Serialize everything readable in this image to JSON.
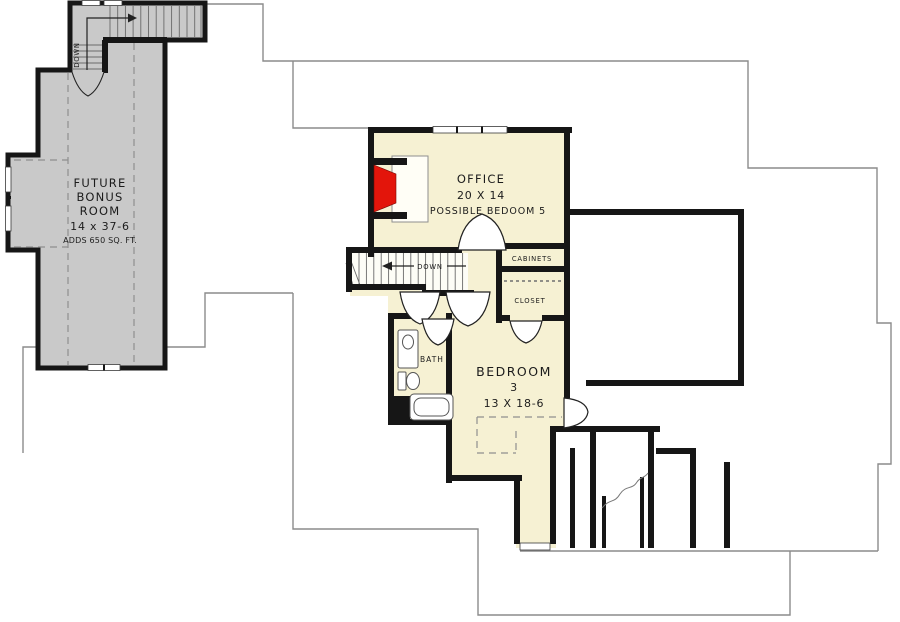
{
  "colors": {
    "wall": "#161616",
    "bonus_fill": "#c9c9c9",
    "room_fill": "#f6f1d3",
    "fireplace": "#e3150b",
    "roof_outline": "#8b8b8b",
    "tread_line": "#6a6a6a",
    "fixture_line": "#555555"
  },
  "plan": {
    "rooms": {
      "bonus_room": {
        "line1": "FUTURE",
        "line2": "BONUS",
        "line3": "ROOM",
        "dims": "14 x 37-6",
        "note": "ADDS 650 SQ. FT."
      },
      "office": {
        "name": "OFFICE",
        "dims": "20 X 14",
        "note": "POSSIBLE BEDOOM 5"
      },
      "bedroom_3": {
        "name": "BEDROOM",
        "number": "3",
        "dims": "13 X 18-6"
      },
      "bath": {
        "name": "BATH"
      },
      "cabinets": {
        "name": "CABINETS"
      },
      "closet": {
        "name": "CLOSET"
      }
    },
    "stairs": {
      "bonus_down_label": "DOWN",
      "main_down_label": "DOWN"
    }
  }
}
